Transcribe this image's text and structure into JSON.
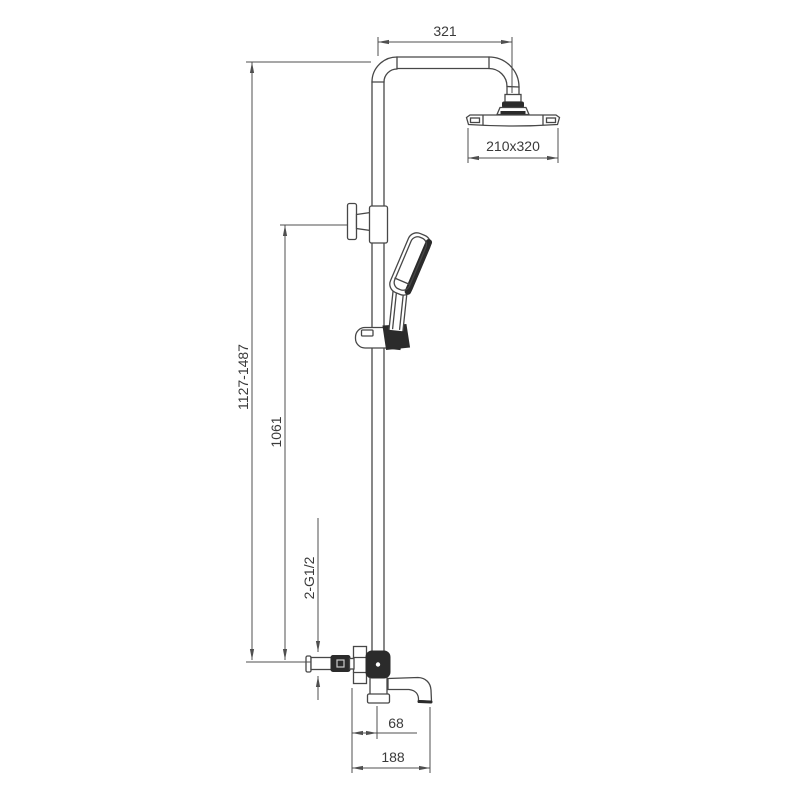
{
  "drawing": {
    "title": "shower-column-dimension-drawing",
    "dimensions": {
      "arm_projection": "321",
      "head_size": "210x320",
      "overall_height_range": "1127-1487",
      "riser_height": "1061",
      "inlet_connections": "2-G1/2",
      "valve_center_offset": "68",
      "spout_reach": "188"
    },
    "colors": {
      "line": "#474747",
      "dark_fill": "#2b2b2b",
      "background": "#ffffff",
      "text": "#3a3a3a"
    }
  }
}
